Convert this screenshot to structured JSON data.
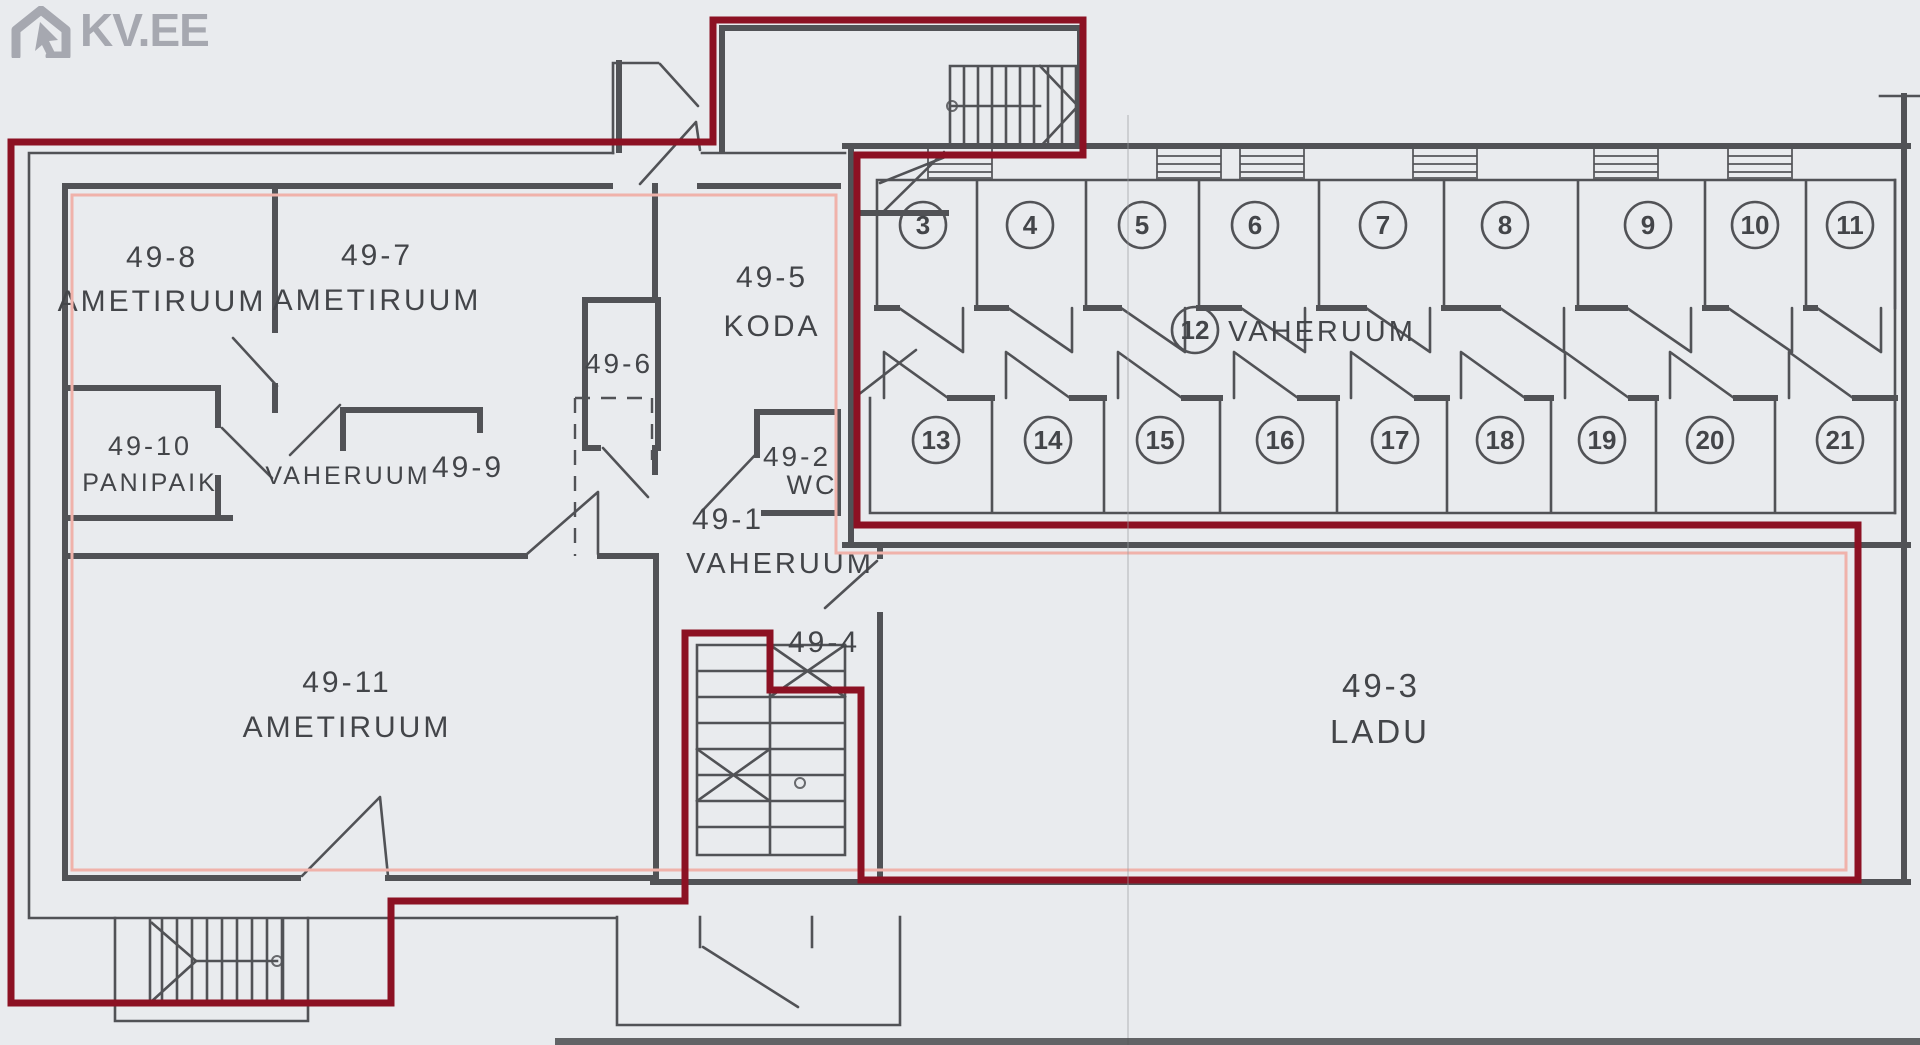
{
  "logo": {
    "text": "KV.EE"
  },
  "colors": {
    "paper": "#e9ebee",
    "line": "#515256",
    "ink": "#434549",
    "maroon": "#8c1123",
    "pink": "#f0b2aa",
    "logo": "#a6a8b0"
  },
  "plan": {
    "room_labels": [
      {
        "text": "49-8",
        "x": 162,
        "y": 267,
        "size": 30
      },
      {
        "text": "AMETIRUUM",
        "x": 162,
        "y": 311,
        "size": 30
      },
      {
        "text": "49-7",
        "x": 377,
        "y": 265,
        "size": 30
      },
      {
        "text": "AMETIRUUM",
        "x": 377,
        "y": 310,
        "size": 30
      },
      {
        "text": "49-5",
        "x": 772,
        "y": 287,
        "size": 30
      },
      {
        "text": "KODA",
        "x": 772,
        "y": 336,
        "size": 30
      },
      {
        "text": "49-6",
        "x": 619,
        "y": 373,
        "size": 28
      },
      {
        "text": "49-10",
        "x": 150,
        "y": 455,
        "size": 27
      },
      {
        "text": "PANIPAIK",
        "x": 150,
        "y": 491,
        "size": 25
      },
      {
        "text": "VAHERUUM",
        "x": 348,
        "y": 484,
        "size": 25
      },
      {
        "text": "49-9",
        "x": 468,
        "y": 477,
        "size": 30
      },
      {
        "text": "49-2",
        "x": 797,
        "y": 466,
        "size": 28
      },
      {
        "text": "WC",
        "x": 812,
        "y": 494,
        "size": 27
      },
      {
        "text": "49-1",
        "x": 728,
        "y": 529,
        "size": 30
      },
      {
        "text": "VAHERUUM",
        "x": 780,
        "y": 573,
        "size": 29
      },
      {
        "text": "49-4",
        "x": 824,
        "y": 652,
        "size": 30
      },
      {
        "text": "49-11",
        "x": 347,
        "y": 692,
        "size": 30
      },
      {
        "text": "AMETIRUUM",
        "x": 347,
        "y": 737,
        "size": 30
      },
      {
        "text": "49-3",
        "x": 1381,
        "y": 697,
        "size": 33
      },
      {
        "text": "LADU",
        "x": 1380,
        "y": 743,
        "size": 33
      }
    ],
    "storage": {
      "circle_radius": 23,
      "top_row_y": 225,
      "bottom_row_y": 440,
      "top_row": [
        {
          "n": "3",
          "x": 923
        },
        {
          "n": "4",
          "x": 1030
        },
        {
          "n": "5",
          "x": 1142
        },
        {
          "n": "6",
          "x": 1255
        },
        {
          "n": "7",
          "x": 1383
        },
        {
          "n": "8",
          "x": 1505
        },
        {
          "n": "9",
          "x": 1648
        },
        {
          "n": "10",
          "x": 1755
        },
        {
          "n": "11",
          "x": 1850
        }
      ],
      "bottom_row": [
        {
          "n": "13",
          "x": 936
        },
        {
          "n": "14",
          "x": 1048
        },
        {
          "n": "15",
          "x": 1160
        },
        {
          "n": "16",
          "x": 1280
        },
        {
          "n": "17",
          "x": 1395
        },
        {
          "n": "18",
          "x": 1500
        },
        {
          "n": "19",
          "x": 1602
        },
        {
          "n": "20",
          "x": 1710
        },
        {
          "n": "21",
          "x": 1840
        }
      ],
      "corridor": {
        "n": "12",
        "x": 1195,
        "y": 330,
        "label": "VAHERUUM",
        "label_x": 1322,
        "label_y": 341,
        "label_size": 29
      }
    }
  }
}
